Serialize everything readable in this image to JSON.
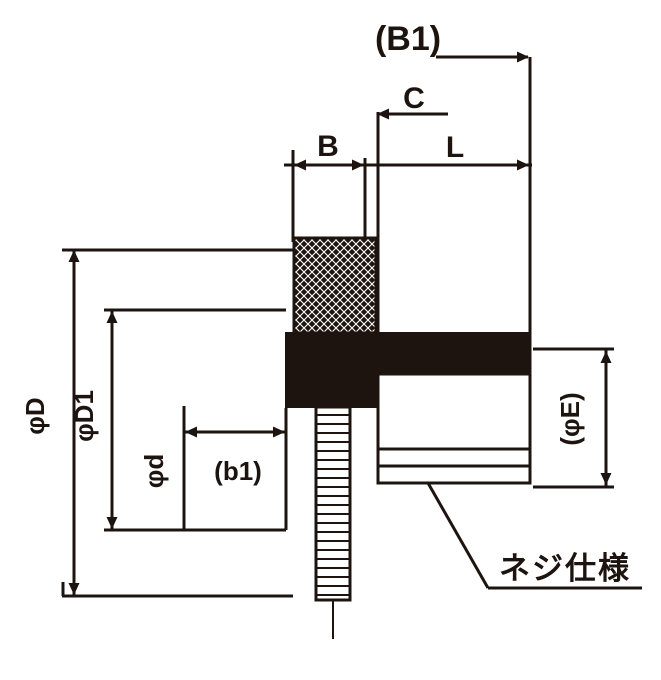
{
  "drawing": {
    "title": "threaded-part-dimension-drawing",
    "labels": {
      "b1_top": "(B1)",
      "c": "C",
      "b": "B",
      "l": "L",
      "phi_d": "φD",
      "phi_d1": "φD1",
      "phi_d_small": "φd",
      "b1_small": "(b1)",
      "phi_e": "(φE)",
      "thread_note": "ネジ仕様"
    },
    "colors": {
      "line": "#1d1410",
      "background": "#ffffff"
    }
  }
}
